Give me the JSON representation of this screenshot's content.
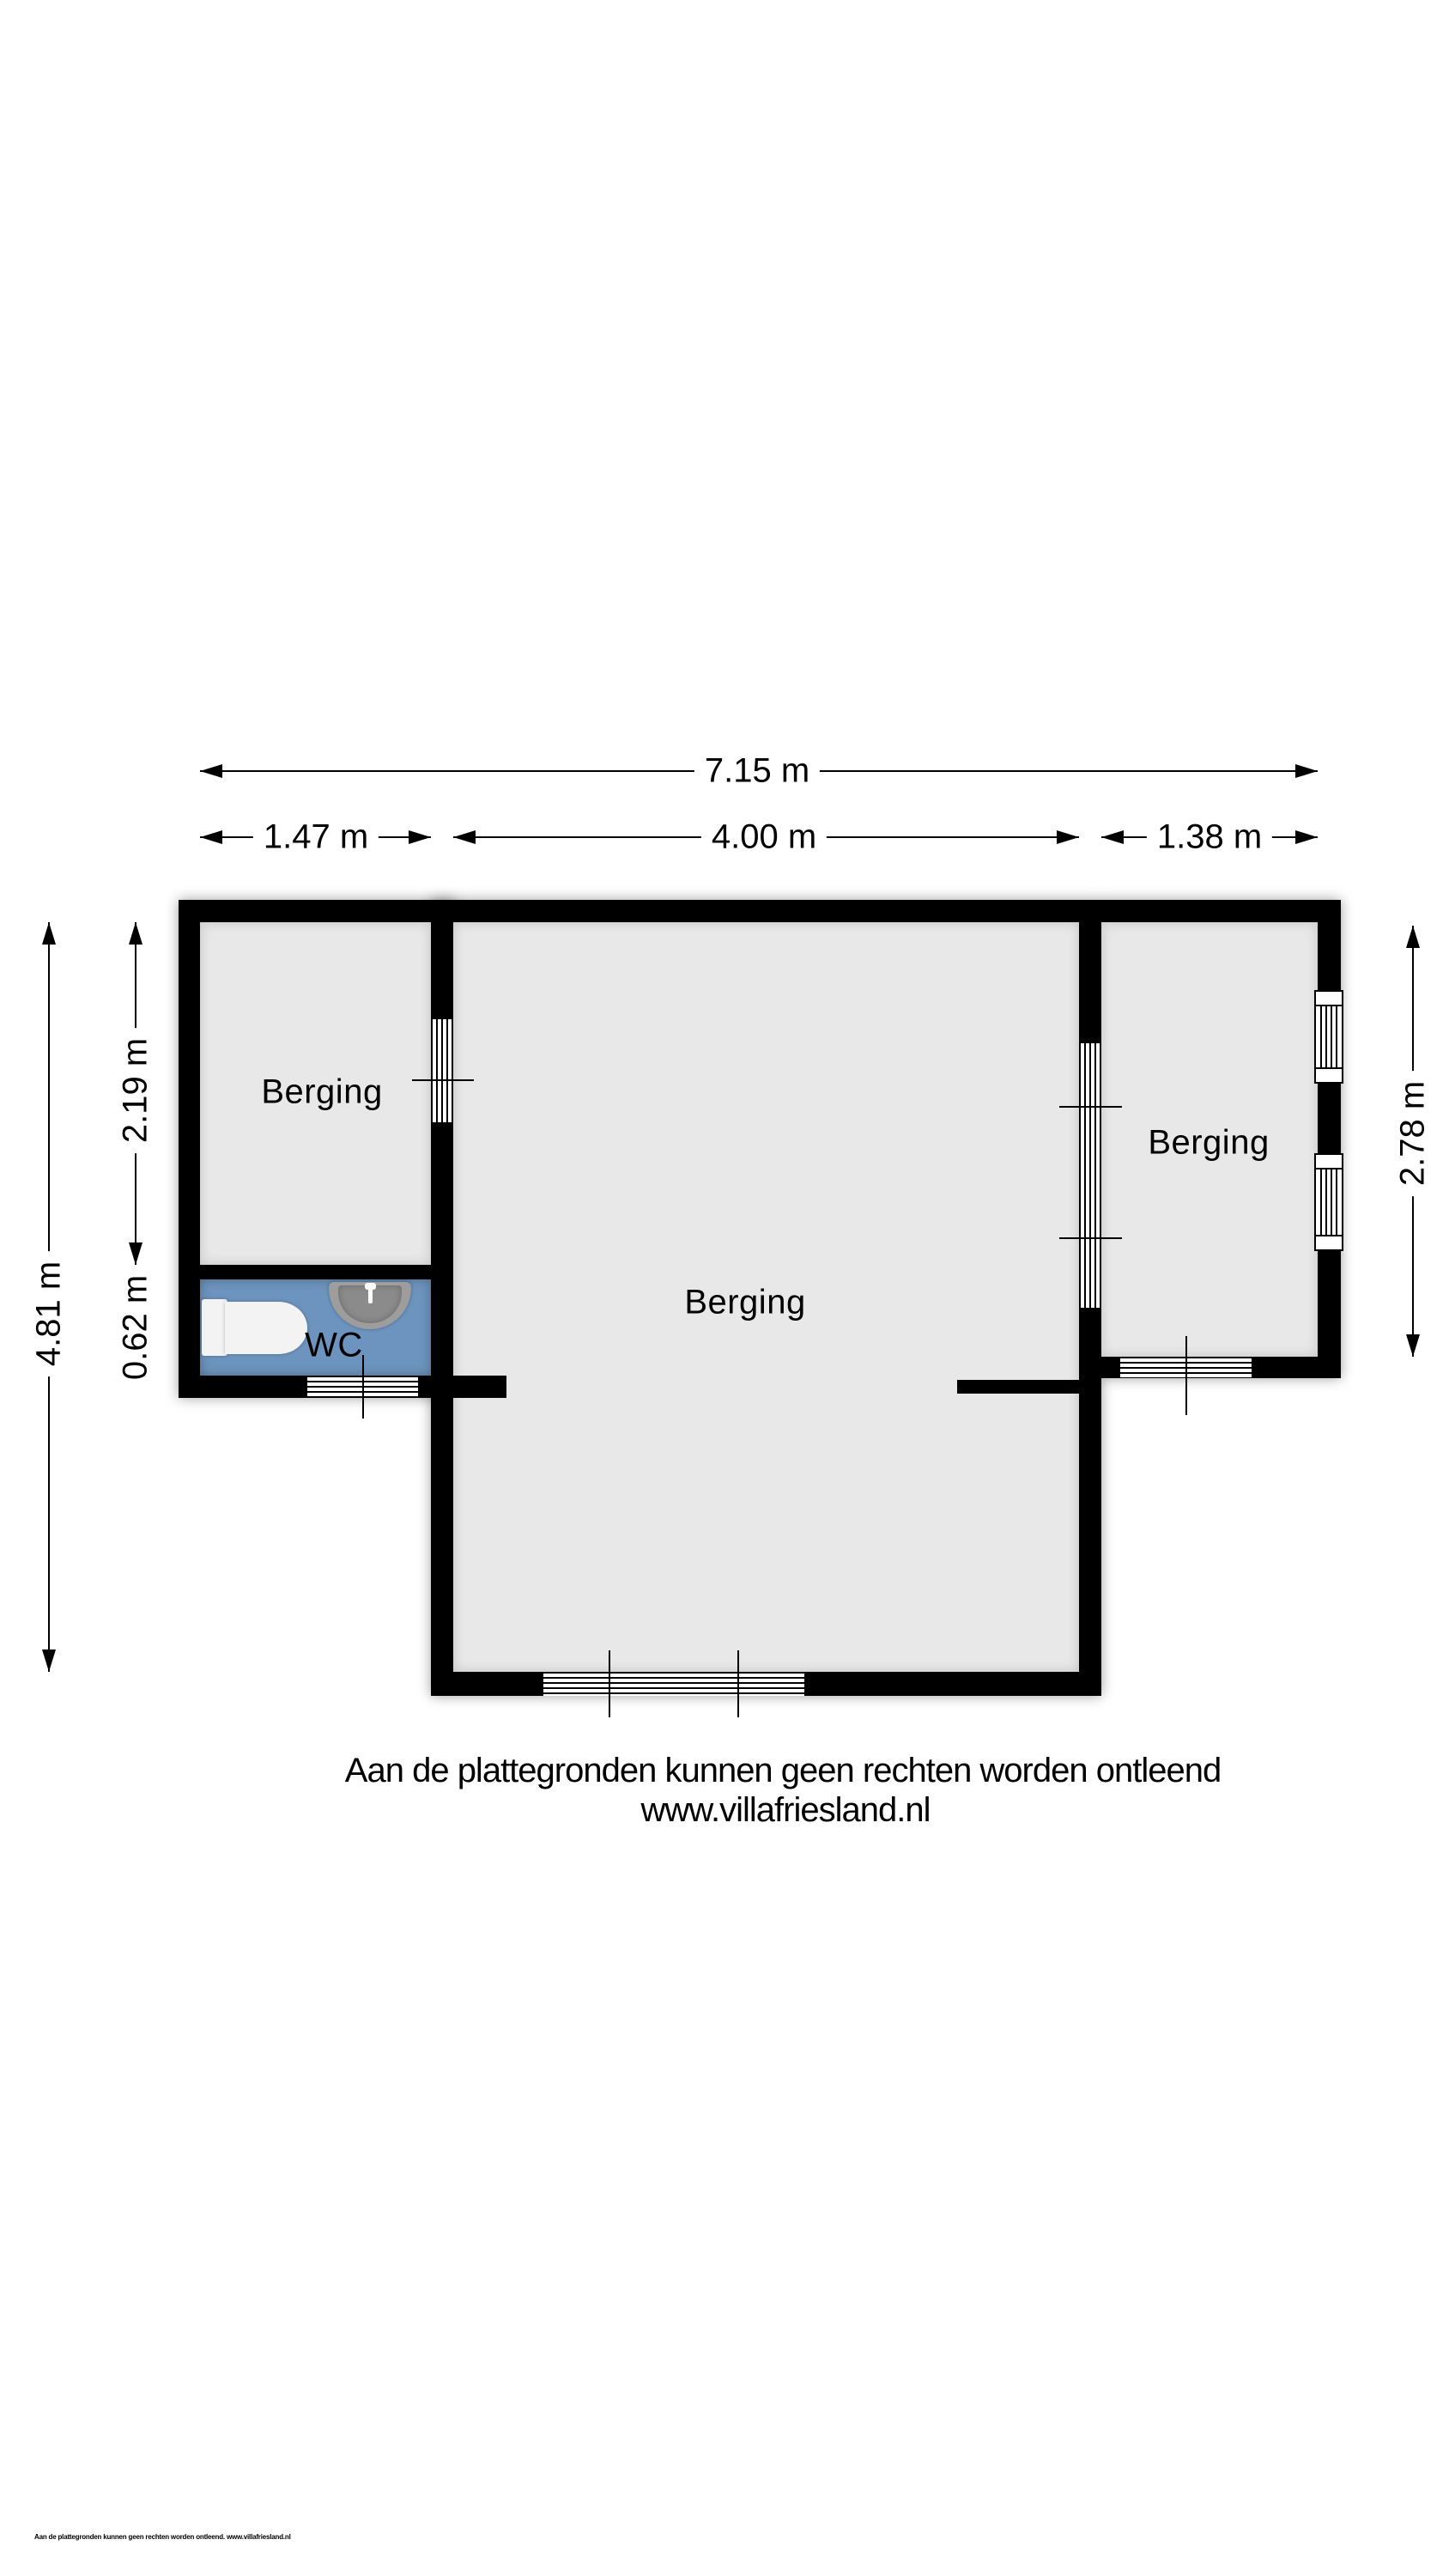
{
  "rooms": {
    "left_label": "Berging",
    "middle_label": "Berging",
    "right_label": "Berging",
    "wc_label": "WC"
  },
  "dimensions": {
    "total_width": "7.15 m",
    "left_width": "1.47 m",
    "middle_width": "4.00 m",
    "right_width": "1.38 m",
    "total_height": "4.81 m",
    "left_room_height": "2.19 m",
    "wc_height": "0.62 m",
    "right_room_height": "2.78 m"
  },
  "footer": {
    "disclaimer": "Aan de plattegronden kunnen geen rechten worden ontleend",
    "website": "www.villafriesland.nl",
    "fineprint": "Aan de plattegronden kunnen geen rechten worden ontleend. www.villafriesland.nl"
  },
  "colors": {
    "wall": "#000000",
    "room_fill": "#e8e8e8",
    "wc_fill": "#6d94be",
    "sink_body": "#9d9d9d",
    "sink_bowl": "#8b8b8b",
    "fixture": "#f3f3f3"
  }
}
